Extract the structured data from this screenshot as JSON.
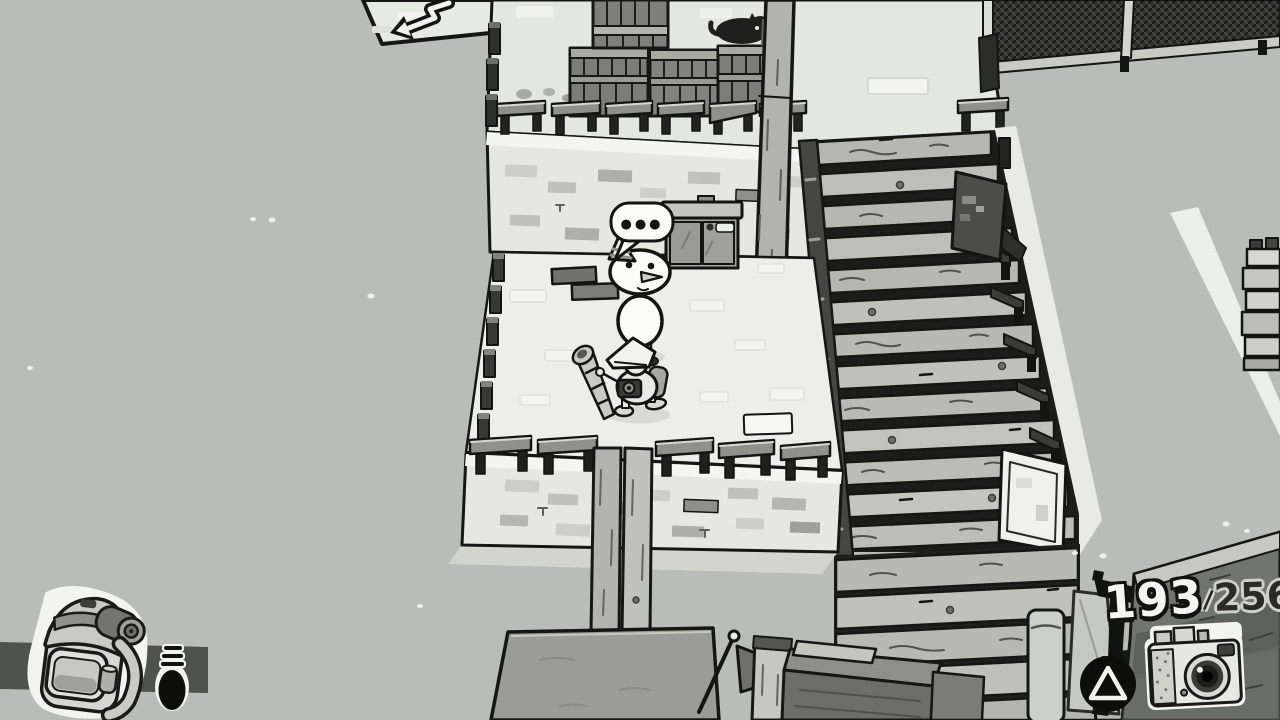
{
  "hud": {
    "photo_counter": {
      "current": "193",
      "separator": "/",
      "total": "256"
    },
    "triangle_button": {
      "glyph": "△"
    },
    "icons": {
      "backpack": "backpack-icon",
      "menu_lines": "touchpad-menu-icon",
      "camera": "camera-icon",
      "triangle": "triangle-button-icon"
    }
  },
  "scene": {
    "speech_bubble_dots": "●●●",
    "entities": [
      "snowman-npc",
      "player-character",
      "black-cat",
      "crate-stack",
      "wooden-stairs",
      "chain-link-fence",
      "pennant-flag",
      "metal-cabinet",
      "wooden-pole",
      "stone-platform"
    ]
  },
  "colors": {
    "background": "#b9bcb8",
    "platform_floor": "#edeeea",
    "upper_platform": "#e4e6e0",
    "stone_wall": "#e6e7e1",
    "wood_plank": "#b8b9b4",
    "dark_wood": "#7c7d78",
    "outline": "#161614",
    "hud_ramp": "#72746e",
    "hud_white": "#f3f4f0",
    "counter_current": "#f4f5f1",
    "counter_total": "#2a2a26"
  }
}
